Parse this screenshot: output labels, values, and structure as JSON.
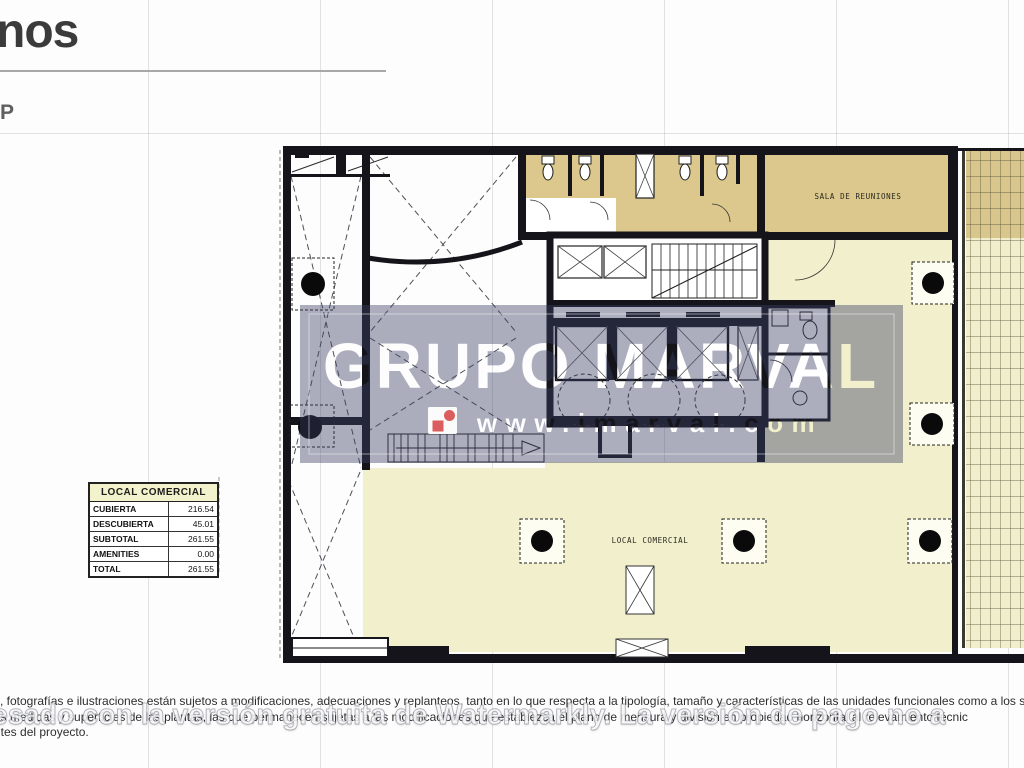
{
  "page": {
    "title_fragment": "nos",
    "floor_label": "P"
  },
  "area_table": {
    "header": "LOCAL COMERCIAL",
    "rows": [
      {
        "label": "CUBIERTA",
        "value": "216.54"
      },
      {
        "label": "DESCUBIERTA",
        "value": "45.01"
      },
      {
        "label": "SUBTOTAL",
        "value": "261.55"
      },
      {
        "label": "AMENITIES",
        "value": "0.00"
      },
      {
        "label": "TOTAL",
        "value": "261.55"
      }
    ]
  },
  "plan": {
    "labels": {
      "meeting_room": "SALA DE REUNIONES",
      "commercial_area": "LOCAL COMERCIAL"
    },
    "colors": {
      "room_tan": "#dcc88c",
      "area_yellow": "#f1efcc",
      "deck_upper": "#d9c68c",
      "deck_lower": "#f1eecb",
      "wall": "#14141a"
    }
  },
  "watermark": {
    "brand": "GRUPO MARVAL",
    "website": "www.imarval.com",
    "box_color": "#3b4067",
    "logo_red": "#d84b4b"
  },
  "watermarkly": {
    "text": "esado con la versión gratuita de Watermarkly. La versión de pago no a"
  },
  "disclaimer": {
    "line1": "s, fotografías e ilustraciones están sujetos a modificaciones, adecuaciones y replanteos, tanto en lo que respecta a la tipología, tamaño y características de las unidades funcionales como a los servicios ge",
    "line2": "as medidas y superficies de las plantas, las que permanecen sujetas a las modificaciones que establezca el plano de mensura y división en propiedad horizontal al relevamiento técnic",
    "line3": "ntes del proyecto."
  }
}
